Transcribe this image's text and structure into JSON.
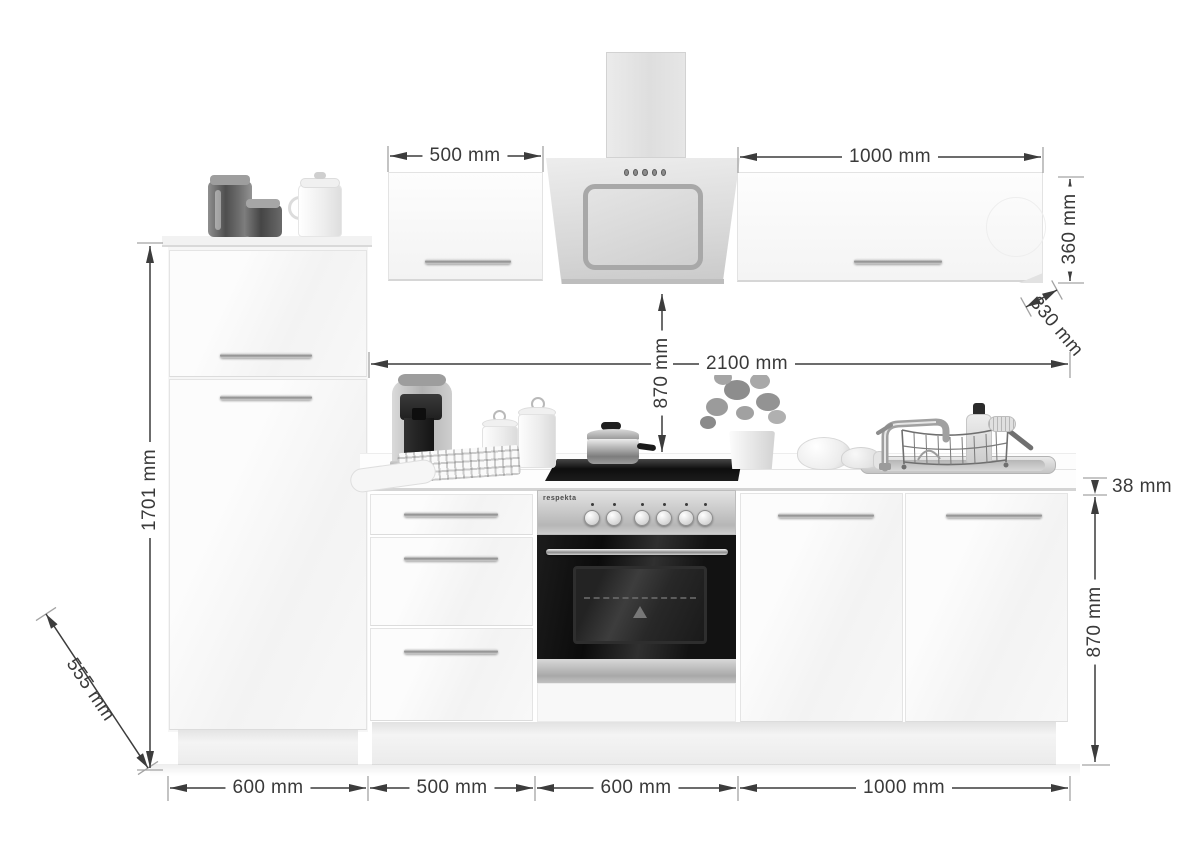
{
  "brand": {
    "oven_label": "respekta"
  },
  "dims": {
    "d500": "500 mm",
    "d1000_top": "1000 mm",
    "d360": "360 mm",
    "d330": "330 mm",
    "d2100": "2100 mm",
    "d870_clearance": "870 mm",
    "d1701": "1701 mm",
    "d38": "38 mm",
    "d870_base": "870 mm",
    "d555": "555 mm",
    "bottom": [
      "600 mm",
      "500 mm",
      "600 mm",
      "1000 mm"
    ]
  },
  "colors": {
    "dimension_line": "#3c3c3c",
    "dimension_text": "#3a3a3a",
    "cabinet_white": "#fafafa",
    "stainless": "#c0c0c0",
    "appliance_black": "#161616"
  }
}
